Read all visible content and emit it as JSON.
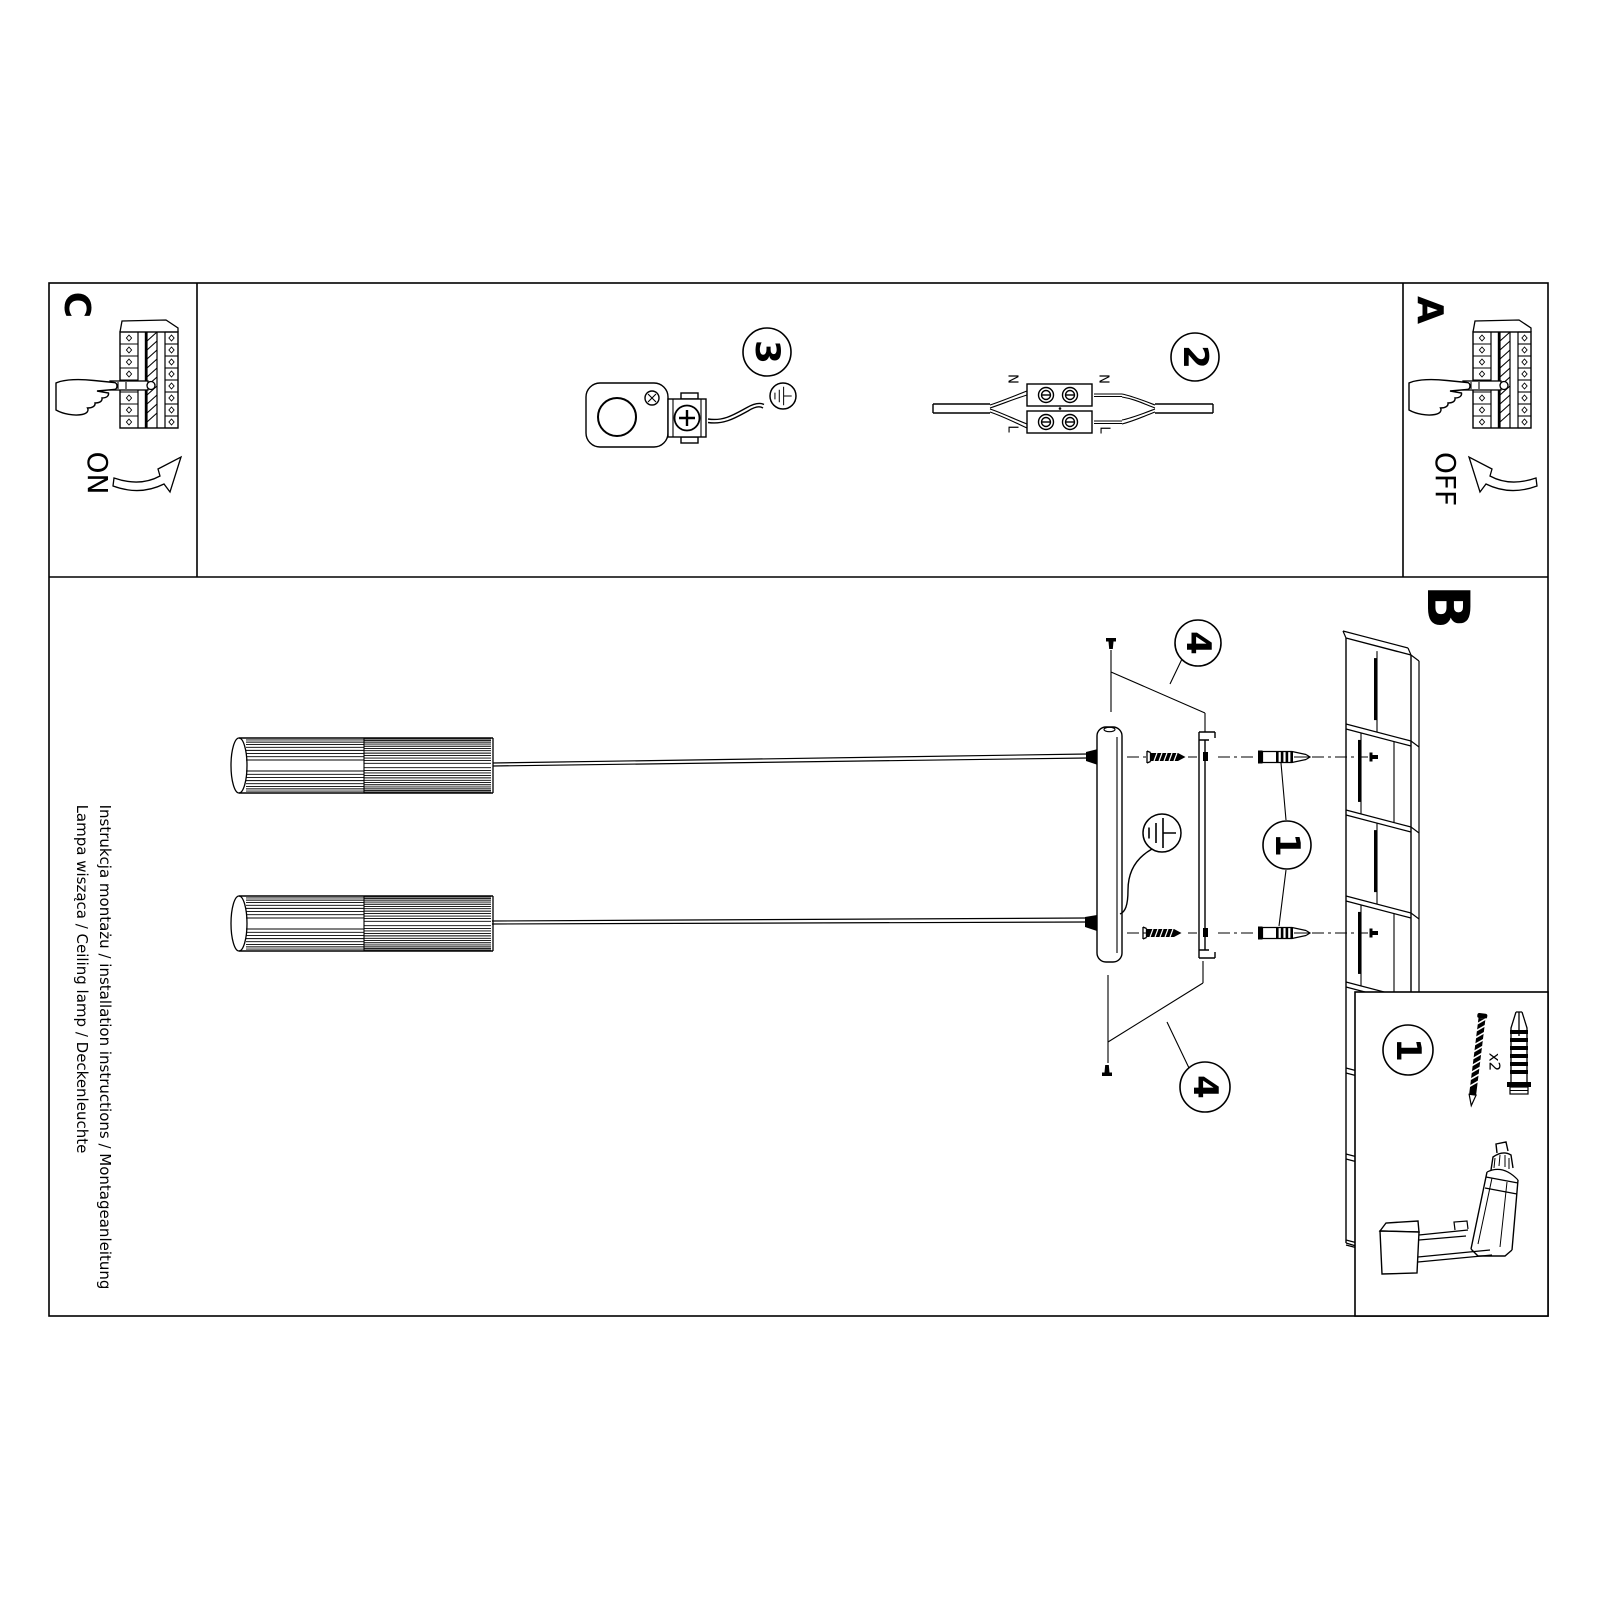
{
  "page": {
    "background": "#ffffff",
    "line_color": "#000000"
  },
  "margin": {
    "line1": "Instrukcja montażu / installation instructions / Montageanleitung",
    "line2": "Lampa wisząca / Ceiling lamp / Deckenleuchte"
  },
  "sections": {
    "a": {
      "label": "A",
      "state": "OFF"
    },
    "b": {
      "label": "B"
    },
    "c": {
      "label": "C",
      "state": "ON"
    }
  },
  "badges": {
    "step1": "1",
    "step2": "2",
    "step3": "3",
    "step4": "4"
  },
  "wiring": {
    "neutral": "N",
    "live": "L"
  },
  "parts_box": {
    "badge": "1",
    "quantity": "x2"
  }
}
